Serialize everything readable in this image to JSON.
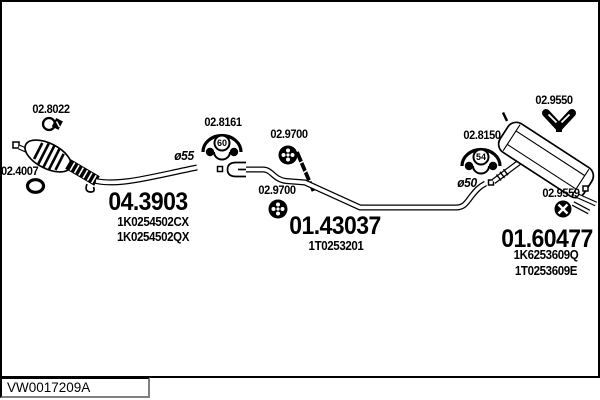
{
  "front": {
    "part_number": "04.3903",
    "oe_number_1": "1K0254502CX",
    "oe_number_2": "1K0254502QX",
    "clamp_number": "02.8022",
    "gasket_number": "02.4007",
    "pipe_diameter": "ø55"
  },
  "centre": {
    "part_number": "01.43037",
    "oe_number_1": "1T0253201",
    "bracket_number": "02.8161",
    "bracket_badge": "60",
    "grommet_number_1": "02.9700",
    "grommet_number_2": "02.9700"
  },
  "rear": {
    "part_number": "01.60477",
    "oe_number_1": "1K6253609Q",
    "oe_number_2": "1T0253609E",
    "mount_number": "02.9550",
    "bracket_number": "02.8150",
    "bracket_badge": "54",
    "grommet_number": "02.9559",
    "pipe_diameter": "ø50"
  },
  "footer": {
    "code": "VW0017209A"
  }
}
